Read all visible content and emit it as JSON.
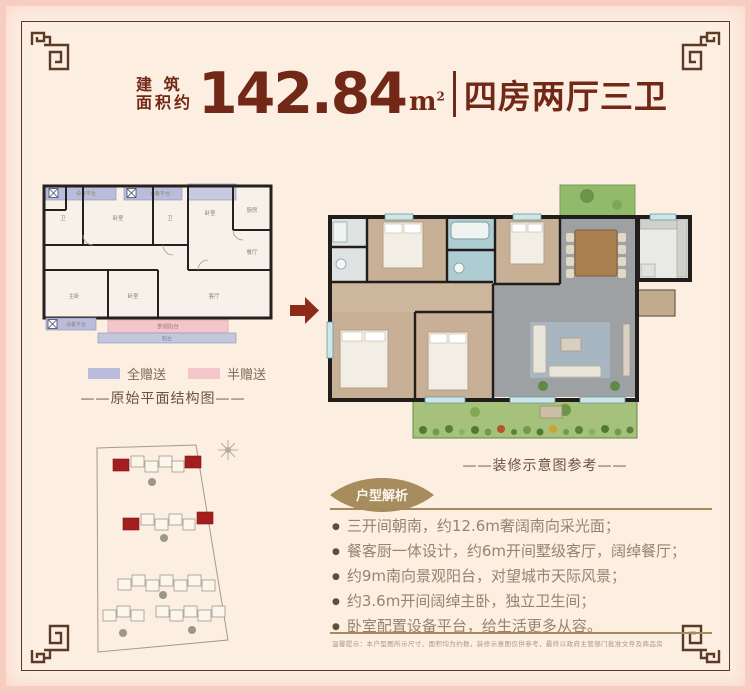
{
  "header": {
    "prefix_top": "建 筑",
    "prefix_bottom": "面积约",
    "area_value": "142.84",
    "area_unit": "m",
    "area_unit_sup": "2",
    "layout_text": "四房两厅三卫"
  },
  "colors": {
    "maroon": "#722817",
    "gold": "#a58a5c",
    "legend_full_gift": "#b9bddb",
    "legend_half_gift": "#f2c6cb",
    "site_highlight_red": "#a31f1f"
  },
  "left_plan": {
    "caption": "——原始平面结构图——",
    "legend": [
      {
        "label": "全赠送",
        "color": "#b9bddb"
      },
      {
        "label": "半赠送",
        "color": "#f2c6cb"
      }
    ],
    "rooms": {
      "equip_top_left": "设备平台",
      "equip_top_right": "设备平台",
      "equip_bottom": "设备平台",
      "wc_left": "卫",
      "bedroom_top_left": "卧室",
      "bath_top": "卫",
      "bedroom_top_mid": "卧室",
      "kitchen": "厨房",
      "dining": "餐厅",
      "master_bedroom": "主卧",
      "bedroom_bottom": "卧室",
      "living": "客厅",
      "balcony_half": "景观阳台",
      "balcony_full": "阳台"
    }
  },
  "right_plan": {
    "caption": "——装修示意图参考——"
  },
  "analysis": {
    "badge": "户型解析",
    "bullets": [
      "三开间朝南，约12.6m奢阔南向采光面；",
      "餐客厨一体设计，约6m开间墅级客厅，阔绰餐厅；",
      "约9m南向景观阳台，对望城市天际风景；",
      "约3.6m开间阔绰主卧，独立卫生间；",
      "卧室配置设备平台，给生活更多从容。"
    ]
  },
  "disclaimer": "温馨提示：本户型图所示尺寸、面积均为约数，装修示意图仅供参考，最终以政府主管部门批准文件及商品房买卖合同约定为准。"
}
